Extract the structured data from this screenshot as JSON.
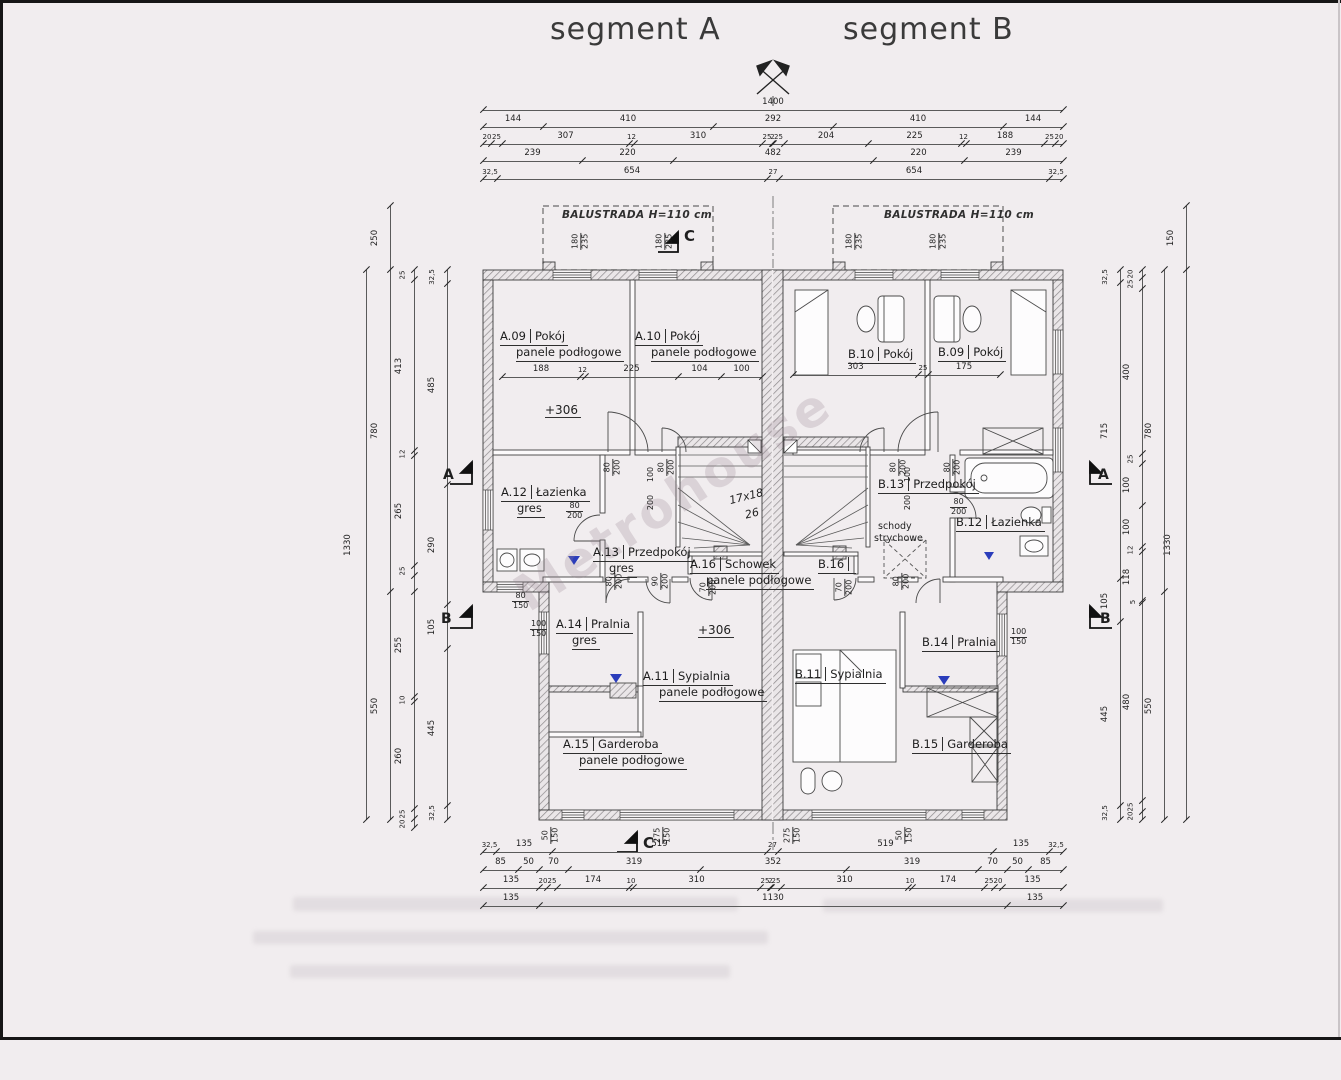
{
  "page": {
    "title_a": "segment A",
    "title_b": "segment B",
    "watermark": "Metrohouse"
  },
  "balcony": {
    "label": "BALUSTRADA H=110 cm"
  },
  "rooms": [
    {
      "id": "A.09",
      "name": "Pokój",
      "floor": "panele podłogowe",
      "x": 500,
      "y": 330
    },
    {
      "id": "A.10",
      "name": "Pokój",
      "floor": "panele podłogowe",
      "x": 635,
      "y": 330
    },
    {
      "id": "B.10",
      "name": "Pokój",
      "floor": "",
      "x": 848,
      "y": 348
    },
    {
      "id": "B.09",
      "name": "Pokój",
      "floor": "",
      "x": 938,
      "y": 346
    },
    {
      "id": "A.12",
      "name": "Łazienka",
      "floor": "gres",
      "x": 501,
      "y": 486
    },
    {
      "id": "A.13",
      "name": "Przedpokój",
      "floor": "gres",
      "x": 593,
      "y": 546
    },
    {
      "id": "B.13",
      "name": "Przedpokój",
      "floor": "",
      "x": 878,
      "y": 478
    },
    {
      "id": "B.12",
      "name": "Łazienka",
      "floor": "",
      "x": 956,
      "y": 516
    },
    {
      "id": "A.16",
      "name": "Schowek",
      "floor": "panele podłogowe",
      "x": 690,
      "y": 558
    },
    {
      "id": "B.16",
      "name": "",
      "floor": "",
      "x": 818,
      "y": 558
    },
    {
      "id": "A.14",
      "name": "Pralnia",
      "floor": "gres",
      "x": 556,
      "y": 618
    },
    {
      "id": "B.14",
      "name": "Pralnia",
      "floor": "",
      "x": 922,
      "y": 636
    },
    {
      "id": "A.11",
      "name": "Sypialnia",
      "floor": "panele podłogowe",
      "x": 643,
      "y": 670
    },
    {
      "id": "B.11",
      "name": "Sypialnia",
      "floor": "",
      "x": 795,
      "y": 668
    },
    {
      "id": "A.15",
      "name": "Garderoba",
      "floor": "panele podłogowe",
      "x": 563,
      "y": 738
    },
    {
      "id": "B.15",
      "name": "Garderoba",
      "floor": "",
      "x": 912,
      "y": 738
    }
  ],
  "chains": [
    {
      "d": "h",
      "y": 110,
      "stops": [
        483,
        1063
      ],
      "labels": [
        "1400"
      ]
    },
    {
      "d": "h",
      "y": 127,
      "stops": [
        483,
        543,
        713,
        833,
        1003,
        1063
      ],
      "labels": [
        "144",
        "410",
        "292",
        "410",
        "144"
      ]
    },
    {
      "d": "h",
      "y": 144,
      "stops": [
        483,
        491,
        502,
        629,
        634,
        762,
        772,
        773,
        784,
        868,
        961,
        966,
        1044,
        1055,
        1063
      ],
      "labels": [
        "20",
        "25",
        "307",
        "12",
        "310",
        "25",
        "2",
        "25",
        "204",
        "225",
        "12",
        "188",
        "25",
        "20"
      ]
    },
    {
      "d": "h",
      "y": 161,
      "stops": [
        483,
        582,
        673,
        873,
        964,
        1063
      ],
      "labels": [
        "239",
        "220",
        "482",
        "220",
        "239"
      ]
    },
    {
      "d": "h",
      "y": 179,
      "stops": [
        483,
        497,
        767,
        779,
        1049,
        1063
      ],
      "labels": [
        "32,5",
        "654",
        "27",
        "654",
        "32,5"
      ]
    },
    {
      "d": "h",
      "y": 852,
      "stops": [
        483,
        496,
        552,
        767,
        778,
        993,
        1049,
        1063
      ],
      "labels": [
        "32,5",
        "135",
        "519",
        "27",
        "519",
        "135",
        "32,5"
      ]
    },
    {
      "d": "h",
      "y": 870,
      "stops": [
        483,
        518,
        539,
        568,
        700,
        846,
        978,
        1007,
        1028,
        1063
      ],
      "labels": [
        "85",
        "50",
        "70",
        "319",
        "352",
        "319",
        "70",
        "50",
        "85"
      ]
    },
    {
      "d": "h",
      "y": 888,
      "stops": [
        483,
        539,
        547,
        557,
        629,
        633,
        760,
        770,
        771,
        781,
        908,
        912,
        984,
        994,
        1002,
        1063
      ],
      "labels": [
        "135",
        "20",
        "25",
        "174",
        "10",
        "310",
        "25",
        "2",
        "25",
        "310",
        "10",
        "174",
        "25",
        "20",
        "135"
      ]
    },
    {
      "d": "h",
      "y": 906,
      "stops": [
        483,
        539,
        1007,
        1063
      ],
      "labels": [
        "135",
        "1130",
        "135"
      ]
    },
    {
      "d": "v",
      "x": 366,
      "stops": [
        270,
        820
      ],
      "labels": [
        "1330"
      ]
    },
    {
      "d": "v",
      "x": 390,
      "stops": [
        206,
        270,
        592,
        820
      ],
      "labels": [
        "250",
        "780",
        "550"
      ]
    },
    {
      "d": "v",
      "x": 414,
      "stops": [
        270,
        280,
        451,
        456,
        566,
        576,
        592,
        697,
        702,
        809,
        819,
        828
      ],
      "labels": [
        "25",
        "413",
        "12",
        "265",
        "25",
        "",
        "255",
        "10",
        "260",
        "25",
        "20"
      ]
    },
    {
      "d": "v",
      "x": 447,
      "stops": [
        270,
        284,
        485,
        605,
        649,
        806,
        820
      ],
      "labels": [
        "32,5",
        "485",
        "290",
        "105",
        "445",
        "32,5"
      ]
    },
    {
      "d": "v",
      "x": 1186,
      "stops": [
        206,
        270,
        820
      ],
      "labels": [
        "150",
        "1330"
      ]
    },
    {
      "d": "v",
      "x": 1164,
      "stops": [
        270,
        592,
        820
      ],
      "labels": [
        "780",
        "550"
      ]
    },
    {
      "d": "v",
      "x": 1142,
      "stops": [
        270,
        278,
        289,
        454,
        464,
        506,
        547,
        552,
        601,
        603,
        801,
        812,
        820
      ],
      "labels": [
        "20",
        "25",
        "400",
        "25",
        "100",
        "100",
        "12",
        "118",
        "5",
        "480",
        "25",
        "20"
      ]
    },
    {
      "d": "v",
      "x": 1120,
      "stops": [
        270,
        283,
        579,
        622,
        806,
        820
      ],
      "labels": [
        "32,5",
        "715",
        "105",
        "445",
        "32,5"
      ]
    },
    {
      "d": "h",
      "y": 377,
      "stops": [
        502,
        580,
        585,
        678,
        721,
        762
      ],
      "labels": [
        "188",
        "12",
        "225",
        "104",
        "100"
      ]
    },
    {
      "d": "h",
      "y": 375,
      "stops": [
        793,
        918,
        928,
        1000
      ],
      "labels": [
        "303",
        "25",
        "175"
      ]
    }
  ],
  "fractions": [
    {
      "x": 572,
      "y": 232,
      "a": "180",
      "b": "235",
      "r": 90
    },
    {
      "x": 656,
      "y": 232,
      "a": "180",
      "b": "235",
      "r": 90
    },
    {
      "x": 846,
      "y": 232,
      "a": "180",
      "b": "235",
      "r": 90
    },
    {
      "x": 930,
      "y": 232,
      "a": "180",
      "b": "235",
      "r": 90
    },
    {
      "x": 604,
      "y": 458,
      "a": "80",
      "b": "200",
      "r": 90
    },
    {
      "x": 658,
      "y": 458,
      "a": "80",
      "b": "200",
      "r": 90
    },
    {
      "x": 890,
      "y": 458,
      "a": "80",
      "b": "200",
      "r": 90
    },
    {
      "x": 944,
      "y": 458,
      "a": "80",
      "b": "200",
      "r": 90
    },
    {
      "x": 566,
      "y": 502,
      "a": "80",
      "b": "200",
      "r": 0
    },
    {
      "x": 606,
      "y": 572,
      "a": "80",
      "b": "200",
      "r": 90
    },
    {
      "x": 652,
      "y": 572,
      "a": "90",
      "b": "200",
      "r": 90
    },
    {
      "x": 700,
      "y": 578,
      "a": "70",
      "b": "200",
      "r": 90
    },
    {
      "x": 836,
      "y": 578,
      "a": "70",
      "b": "200",
      "r": 90
    },
    {
      "x": 893,
      "y": 572,
      "a": "80",
      "b": "200",
      "r": 90
    },
    {
      "x": 950,
      "y": 498,
      "a": "80",
      "b": "200",
      "r": 0
    },
    {
      "x": 512,
      "y": 592,
      "a": "80",
      "b": "150",
      "r": 0
    },
    {
      "x": 530,
      "y": 620,
      "a": "100",
      "b": "150",
      "r": 0
    },
    {
      "x": 1010,
      "y": 628,
      "a": "100",
      "b": "150",
      "r": 0
    },
    {
      "x": 542,
      "y": 826,
      "a": "50",
      "b": "150",
      "r": 90
    },
    {
      "x": 654,
      "y": 826,
      "a": "275",
      "b": "150",
      "r": 90
    },
    {
      "x": 784,
      "y": 826,
      "a": "275",
      "b": "150",
      "r": 90
    },
    {
      "x": 896,
      "y": 826,
      "a": "50",
      "b": "150",
      "r": 90
    }
  ],
  "notes": [
    {
      "t": "100",
      "x": 643,
      "y": 470,
      "r": -90,
      "s": 8
    },
    {
      "t": "200",
      "x": 643,
      "y": 498,
      "r": -90,
      "s": 8
    },
    {
      "t": "100",
      "x": 900,
      "y": 470,
      "r": -90,
      "s": 8
    },
    {
      "t": "200",
      "x": 900,
      "y": 498,
      "r": -90,
      "s": 8
    },
    {
      "t": "17x18",
      "x": 729,
      "y": 490,
      "r": -14,
      "s": 11,
      "i": 1
    },
    {
      "t": "26",
      "x": 745,
      "y": 507,
      "r": -14,
      "s": 11,
      "i": 1
    },
    {
      "t": "schody",
      "x": 878,
      "y": 521,
      "s": 9.5
    },
    {
      "t": "strychowe",
      "x": 874,
      "y": 533,
      "s": 9.5
    },
    {
      "t": "+306",
      "x": 545,
      "y": 403,
      "s": 12,
      "lvl": 1
    },
    {
      "t": "+306",
      "x": 698,
      "y": 623,
      "s": 12,
      "lvl": 1
    },
    {
      "t": "C",
      "x": 684,
      "y": 227,
      "s": 15,
      "b": 1
    },
    {
      "t": "A",
      "x": 443,
      "y": 467,
      "s": 14,
      "b": 1
    },
    {
      "t": "B",
      "x": 441,
      "y": 611,
      "s": 14,
      "b": 1
    },
    {
      "t": "A",
      "x": 1098,
      "y": 467,
      "s": 14,
      "b": 1
    },
    {
      "t": "B",
      "x": 1100,
      "y": 611,
      "s": 14,
      "b": 1
    },
    {
      "t": "C",
      "x": 643,
      "y": 834,
      "s": 15,
      "b": 1
    }
  ]
}
